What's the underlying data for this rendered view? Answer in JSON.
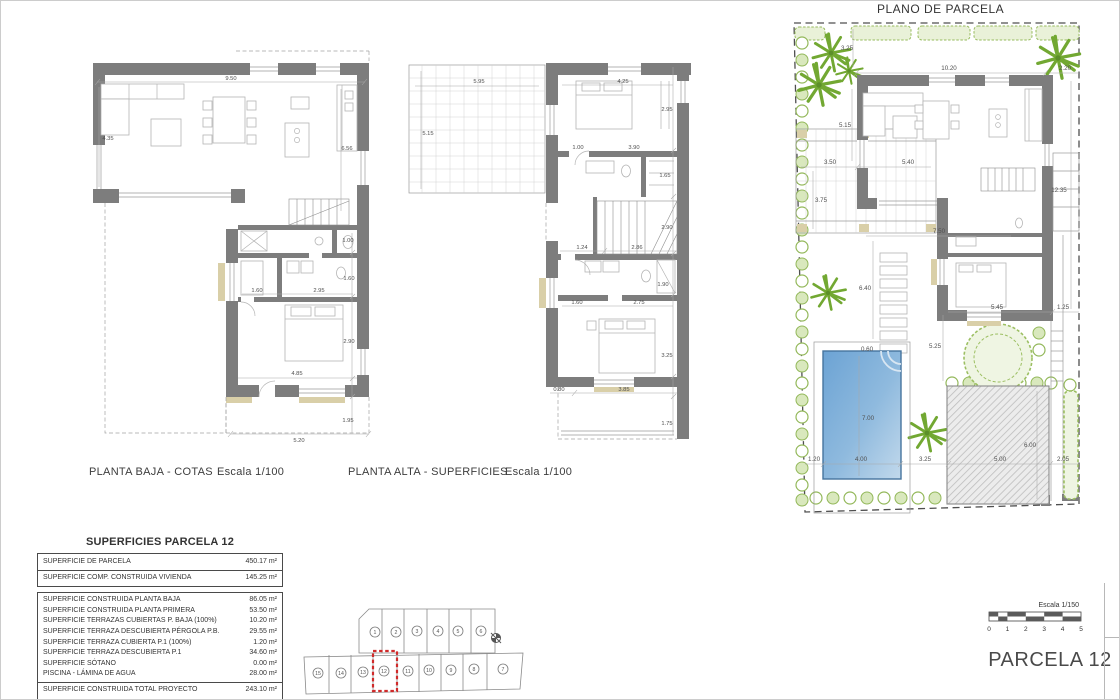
{
  "titles": {
    "plano_parcela": "PLANO DE PARCELA",
    "sheet": "PARCELA 12"
  },
  "captions": {
    "baja": "PLANTA BAJA - COTAS",
    "baja_scale": "Escala 1/100",
    "alta": "PLANTA ALTA - SUPERFICIES",
    "alta_scale": "Escala 1/100"
  },
  "scalebar": {
    "label": "Escala 1/150",
    "ticks": [
      "0",
      "1",
      "2",
      "3",
      "4",
      "5"
    ]
  },
  "table": {
    "title": "SUPERFICIES PARCELA 12",
    "section1": [
      {
        "label": "SUPERFICIE DE PARCELA",
        "value": "450.17 m²"
      },
      {
        "label": "SUPERFICIE COMP. CONSTRUIDA VIVIENDA",
        "value": "145.25 m²"
      }
    ],
    "section2": [
      {
        "label": "SUPERFICIE CONSTRUIDA PLANTA BAJA",
        "value": "86.05 m²"
      },
      {
        "label": "SUPERFICIE CONSTRUIDA PLANTA PRIMERA",
        "value": "53.50 m²"
      },
      {
        "label": "SUPERFICIE TERRAZAS CUBIERTAS P. BAJA (100%)",
        "value": "10.20 m²"
      },
      {
        "label": "SUPERFICIE TERRAZA DESCUBIERTA PÉRGOLA P.B.",
        "value": "29.55 m²"
      },
      {
        "label": "SUPERFICIE TERRAZA CUBIERTA P.1 (100%)",
        "value": "1.20 m²"
      },
      {
        "label": "SUPERFICIE TERRAZA DESCUBIERTA P.1",
        "value": "34.60 m²"
      },
      {
        "label": "SUPERFICIE SÓTANO",
        "value": "0.00 m²"
      },
      {
        "label": "PISCINA - LÁMINA DE AGUA",
        "value": "28.00 m²"
      }
    ],
    "total": {
      "label": "SUPERFICIE CONSTRUIDA TOTAL PROYECTO",
      "value": "243.10 m²"
    }
  },
  "keyplan": {
    "top_lots": [
      "1",
      "2",
      "3",
      "4",
      "5",
      "6"
    ],
    "bottom_lots": [
      "15",
      "14",
      "13",
      "12",
      "11",
      "10",
      "9",
      "8",
      "7"
    ],
    "highlighted_lot": "12"
  },
  "dims": {
    "baja": [
      "9.50",
      "4.35",
      "6.56",
      "1.00",
      "1.60",
      "1.60",
      "2.95",
      "2.90",
      "4.85",
      "1.95",
      "5.20"
    ],
    "alta": [
      "5.95",
      "5.15",
      "4.25",
      "2.95",
      "1.00",
      "3.90",
      "1.65",
      "2.90",
      "1.24",
      "2.86",
      "1.90",
      "1.60",
      "2.75",
      "3.25",
      "0.80",
      "3.85",
      "1.75"
    ],
    "parcela": [
      "3.25",
      "10.20",
      "2.20",
      "5.15",
      "3.50",
      "5.40",
      "3.75",
      "12.35",
      "7.50",
      "6.40",
      "5.45",
      "1.25",
      "5.25",
      "0.60",
      "7.00",
      "6.00",
      "1.20",
      "4.00",
      "3.25",
      "5.00",
      "2.05"
    ]
  },
  "colors": {
    "wall": "#7d7d7d",
    "accent_tan": "#d9cfa8",
    "pool": "#6ca3d4",
    "vegetation": "#72a832",
    "highlight_red": "#d02a2a"
  }
}
